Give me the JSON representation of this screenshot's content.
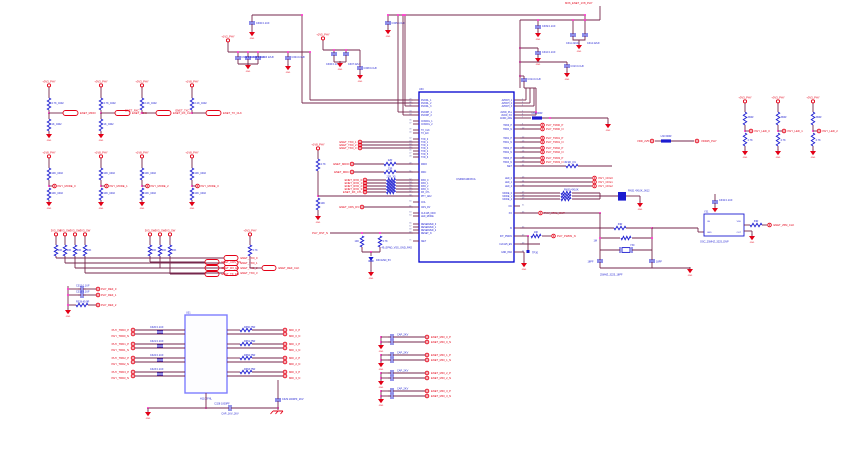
{
  "misc": {
    "gnd": "GND"
  },
  "colors": {
    "wire": "#76274C",
    "component_blue": "#1B1BD0",
    "accent_red": "#E30016",
    "junction_pink": "#FF29C8",
    "ic_border": "#0000D0",
    "magnetics_border": "#7D7DFF"
  },
  "ic": {
    "ref": "U30",
    "part": "KSZ9031RNXCA",
    "pad_note": "49_EPAD_VSS_GND_PAD",
    "left_pins": [
      {
        "n": "29",
        "l": "DVDDL_1"
      },
      {
        "n": "30",
        "l": "DVDDL_2"
      },
      {
        "n": "31",
        "l": "DVDDL_3"
      },
      {
        "n": "33",
        "l": "DVDDH_1"
      },
      {
        "n": "34",
        "l": "DVDDH_2"
      },
      {
        "n": "36",
        "l": "CONFIG_1"
      },
      {
        "n": "37",
        "l": "CONFIG_2"
      },
      {
        "n": "39",
        "l": "TX_CLK"
      },
      {
        "n": "40",
        "l": "TX_EN"
      },
      {
        "n": "42",
        "l": "TXD_0"
      },
      {
        "n": "43",
        "l": "TXD_1"
      },
      {
        "n": "44",
        "l": "TXD_2"
      },
      {
        "n": "45",
        "l": "TXD_3"
      },
      {
        "n": "46",
        "l": "TXD_4"
      },
      {
        "n": "47",
        "l": "TXD_5"
      },
      {
        "n": "48",
        "l": "TXD_6"
      },
      {
        "n": "49",
        "l": "MDIO"
      },
      {
        "n": "51",
        "l": "MDC"
      },
      {
        "n": "52",
        "l": "RXD_0"
      },
      {
        "n": "54",
        "l": "RXD_1"
      },
      {
        "n": "55",
        "l": "RXD_2"
      },
      {
        "n": "56",
        "l": "RXD_3"
      },
      {
        "n": "57",
        "l": "RX_CTL"
      },
      {
        "n": "58",
        "l": "PHY_AD2"
      },
      {
        "n": "60",
        "l": "COL"
      },
      {
        "n": "61",
        "l": "CRS_DV"
      },
      {
        "n": "63",
        "l": "CLK125_NDO"
      },
      {
        "n": "64",
        "l": "LED_MODE"
      },
      {
        "n": "66",
        "l": "RESERVED_0"
      },
      {
        "n": "67",
        "l": "RESERVED_1"
      },
      {
        "n": "68",
        "l": "RESERVED_2"
      },
      {
        "n": "69",
        "l": "RESET_N"
      },
      {
        "n": "71",
        "l": "ISET"
      }
    ],
    "right_pins": [
      {
        "n": "1",
        "l": "AVDDH_1"
      },
      {
        "n": "2",
        "l": "AVDDH_2"
      },
      {
        "n": "3",
        "l": "AVDDH_3"
      },
      {
        "n": "5",
        "l": "AVDD_PLL"
      },
      {
        "n": "6",
        "l": "AVDD_XO"
      },
      {
        "n": "7",
        "l": "AVDD_AFE"
      },
      {
        "n": "9",
        "l": "TRD0_P"
      },
      {
        "n": "10",
        "l": "TRD0_N"
      },
      {
        "n": "12",
        "l": "TRD1_P"
      },
      {
        "n": "13",
        "l": "TRD1_N"
      },
      {
        "n": "15",
        "l": "TRD2_P"
      },
      {
        "n": "16",
        "l": "TRD2_N"
      },
      {
        "n": "18",
        "l": "TRD3_P"
      },
      {
        "n": "19",
        "l": "TRD3_N"
      },
      {
        "n": "21",
        "l": "ISET"
      },
      {
        "n": "23",
        "l": "LED_0"
      },
      {
        "n": "24",
        "l": "LED_1"
      },
      {
        "n": "25",
        "l": "LED_2"
      },
      {
        "n": "27",
        "l": "MODE_0"
      },
      {
        "n": "28",
        "l": "MODE_1"
      },
      {
        "n": "29",
        "l": "MODE_2"
      },
      {
        "n": "31",
        "l": "NC"
      },
      {
        "n": "33",
        "l": "XO"
      },
      {
        "n": "35",
        "l": "XI"
      },
      {
        "n": "37",
        "l": "INT_PWDN"
      },
      {
        "n": "39",
        "l": "CLK125_EN"
      },
      {
        "n": "41",
        "l": "GND_PAD"
      }
    ]
  },
  "top_left": {
    "pwr": "+1V2_PHY",
    "caps": [
      "C300 0.1UF",
      "C301 0.1UF",
      "C302 0.1UF",
      "C303 22UF",
      "C304 0.1UF"
    ]
  },
  "top_mid": {
    "pwr": "+2V5_PHY",
    "caps": [
      "C305 0.1UF",
      "C306 0.1UF",
      "C307 22UF",
      "C308 0.1UF"
    ]
  },
  "top_right": {
    "pwr_net": "MX6_ENET_1V8_PHY",
    "caps": [
      "C309 0.1UF",
      "C310 0.1UF",
      "C311 22UF",
      "C312 22UF",
      "C313 0.1UF",
      "C314 0.1UF"
    ]
  },
  "row1": [
    {
      "pwr": "+3V3_PHY",
      "r1": "4.7K_0402",
      "r2": "1K_0402",
      "tag": "ENET_MDIO",
      "net": ""
    },
    {
      "pwr": "+3V3_PHY",
      "r1": "4.7K_0402",
      "r2": "1K_0402",
      "tag": "ENET_MDC",
      "net": ""
    },
    {
      "pwr": "+3V3_PHY",
      "r1": "2.2K_0402",
      "tag": "ENET_RX_CLK",
      "net": "ENET_RXC"
    },
    {
      "pwr": "+1V8_PHY",
      "r1": "2.2K_0402",
      "tag": "ENET_TX_CLK",
      "net": "ENET_TXC"
    }
  ],
  "row2": [
    {
      "pwr": "+1V8_PHY",
      "r1": "10K_0402",
      "r2": "10K_0402",
      "net": "PHY_MODE_0"
    },
    {
      "pwr": "+1V8_PHY",
      "r1": "10K_0402",
      "r2": "10K_0402",
      "net": "PHY_MODE_1"
    },
    {
      "pwr": "+1V8_PHY",
      "r1": "10K_0402",
      "r2": "10K_0402",
      "net": "PHY_MODE_2"
    },
    {
      "pwr": "+1V8_PHY",
      "r1": "10K_0402",
      "r2": "10K_0402",
      "net": "PHY_MODE_3"
    }
  ],
  "g1": {
    "pwr": "3V3_SW",
    "rs": [
      "10K",
      "10K",
      "10K",
      "10K"
    ],
    "tags": [
      "ENET_TXD_0",
      "ENET_TXD_1",
      "ENET_TXD_2",
      "ENET_TXD_3"
    ]
  },
  "g2": {
    "pwr": "3V3_SW",
    "rs": [
      "10K",
      "10K",
      "10K"
    ],
    "tags": [
      "ENET_CRS_DV",
      "ENET_RX_ER",
      "ENET_TX_EN"
    ]
  },
  "g3": {
    "pwr": "+3V3_PHY",
    "r": "4.7K",
    "tag": "ENET_REF_CLK"
  },
  "trio": [
    {
      "c": "C315 0.1UF",
      "net": "PHY_REF_0"
    },
    {
      "c": "C316 0.1UF",
      "net": "PHY_REF_1"
    },
    {
      "c": "R328 49.9R",
      "net": "PHY_REF_2"
    }
  ],
  "mag": {
    "ref": "U31",
    "part": "H1102FNL",
    "ct_cap": "C328 1000PF",
    "ct_cap2": "C329 1000PF_2KV",
    "ct_note": "CAP_1KV_2KV",
    "ch": [
      {
        "lp": "PHY_TRD0_P",
        "ln": "PHY_TRD0_N",
        "cap": "C320 0.1UF",
        "res": "R350 75R",
        "op": "MDI_0_P",
        "on": "MDI_0_N"
      },
      {
        "lp": "PHY_TRD1_P",
        "ln": "PHY_TRD1_N",
        "cap": "C321 0.1UF",
        "res": "R351 75R",
        "op": "MDI_1_P",
        "on": "MDI_1_N"
      },
      {
        "lp": "PHY_TRD2_P",
        "ln": "PHY_TRD2_N",
        "cap": "C322 0.1UF",
        "res": "R352 75R",
        "op": "MDI_2_P",
        "on": "MDI_2_N"
      },
      {
        "lp": "PHY_TRD3_P",
        "ln": "PHY_TRD3_N",
        "cap": "C323 0.1UF",
        "res": "R353 75R",
        "op": "MDI_3_P",
        "on": "MDI_3_N"
      }
    ]
  },
  "bcaps": [
    {
      "cp": "CAP_2KV",
      "cn": "CAP_2KV",
      "np": "ENET_MDI_0_P",
      "nn": "ENET_MDI_0_N"
    },
    {
      "cp": "CAP_2KV",
      "cn": "CAP_2KV",
      "np": "ENET_MDI_1_P",
      "nn": "ENET_MDI_1_N"
    },
    {
      "cp": "CAP_2KV",
      "cn": "CAP_2KV",
      "np": "ENET_MDI_2_P",
      "nn": "ENET_MDI_2_N"
    },
    {
      "cp": "CAP_2KV",
      "cn": "CAP_2KV",
      "np": "ENET_MDI_3_P",
      "nn": "ENET_MDI_3_N"
    }
  ],
  "leds": [
    {
      "pwr": "+3V3_PHY",
      "r1": "330R",
      "r2": "4.7K",
      "net": "PHY_LED_0"
    },
    {
      "pwr": "+3V3_PHY",
      "r1": "330R",
      "r2": "4.7K",
      "net": "PHY_LED_1"
    },
    {
      "pwr": "+3V3_PHY",
      "r1": "330R",
      "r2": "4.7K",
      "net": "PHY_LED_2"
    }
  ],
  "bead_link": {
    "left": "VDD_2V5",
    "label": "L30 600R",
    "right": "VDD25_PHY"
  },
  "bead2": {
    "label": "L31 600R"
  },
  "pairs": [
    {
      "p": "PHY_TRD0_P",
      "n": "PHY_TRD0_N"
    },
    {
      "p": "PHY_TRD1_P",
      "n": "PHY_TRD1_N"
    },
    {
      "p": "PHY_TRD2_P",
      "n": "PHY_TRD2_N"
    },
    {
      "p": "PHY_TRD3_P",
      "n": "PHY_TRD3_N"
    }
  ],
  "riso": {
    "r": "49.9R_1%"
  },
  "rn": {
    "nets": [
      "PHY_CFG0",
      "PHY_CFG1",
      "PHY_CFG2"
    ],
    "label": "RN30 4X10K",
    "block": "RN31 4X10K_0612"
  },
  "irow": {
    "net": "PHY_XTAL_OUT"
  },
  "pwdn": {
    "r": "10K",
    "net": "PHY_PWDN_N",
    "tp": "TP30"
  },
  "xtal": {
    "rs": "33R",
    "rp": "1M",
    "ref": "Y30",
    "val": "25MHZ_3225_18PF",
    "c1": "18PF",
    "c2": "18PF"
  },
  "osc": {
    "ref": "Y31",
    "part": "OSC_25MHZ_3225_DNP",
    "cap": "C332 0.1UF",
    "pins": [
      "OE",
      "VDD",
      "GND",
      "OUT"
    ],
    "r": "33R",
    "net": "ENET_25M_CLK"
  },
  "pre": {
    "trio": [
      "ENET_TXD_1",
      "ENET_TXD_2",
      "ENET_TXD_3"
    ],
    "mdio": {
      "net": "ENET_MDIO",
      "r": "22R"
    },
    "mdc": {
      "net": "ENET_MDC",
      "r": "22R"
    },
    "rxnets": [
      "ENET_RXD_0",
      "ENET_RXD_1",
      "ENET_RXD_2",
      "ENET_RXD_3",
      "ENET_RX_CTL"
    ],
    "rxr": "22R_X5",
    "crs": {
      "net": "ENET_CRS_DV"
    },
    "div": {
      "pwr": "+1V8_PHY",
      "r1": "4.7K",
      "r2": "10K"
    },
    "pull": {
      "net": "PHY_RST_N",
      "r1": "10K",
      "r2": "4.7K",
      "d": "D30 ESD_5V"
    }
  }
}
